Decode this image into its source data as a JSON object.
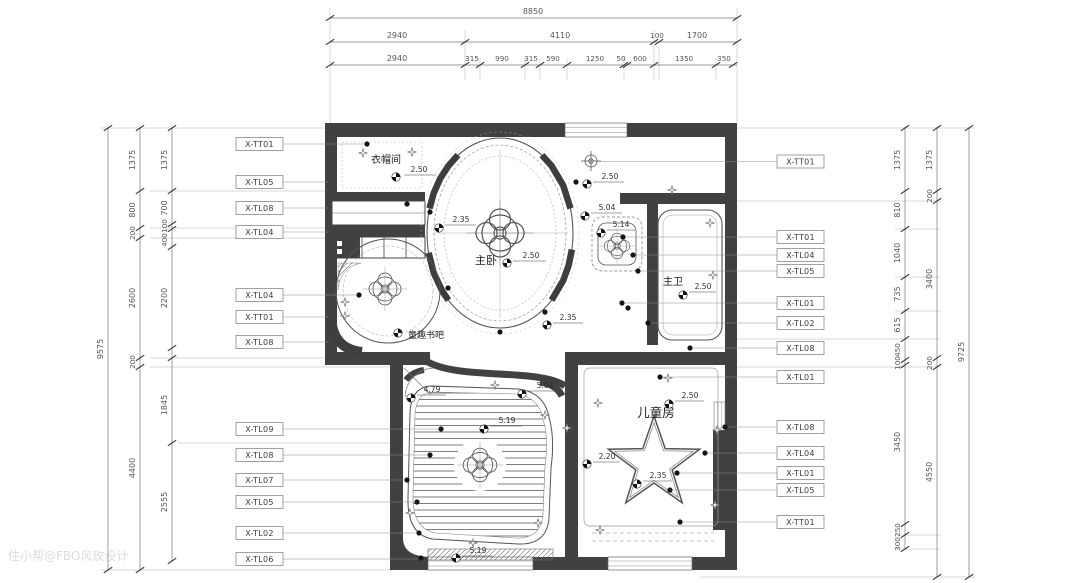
{
  "watermark": "住小帮@FBO风玫设计",
  "dims": {
    "top": {
      "total": "8850",
      "row2": [
        "2940",
        "4110",
        "100",
        "1700"
      ],
      "row3": [
        "2940",
        "315",
        "990",
        "315",
        "590",
        "1250",
        "50",
        "600",
        "1350",
        "350"
      ]
    },
    "left": {
      "total": "9575",
      "mid": [
        "1375",
        "800",
        "200",
        "2600",
        "200",
        "4400"
      ],
      "inner": [
        "1375",
        "700",
        "100",
        "400",
        "2200",
        "1845",
        "2555"
      ]
    },
    "right": {
      "total": "9725",
      "mid": [
        "1375",
        "200",
        "3400",
        "200",
        "4550"
      ],
      "inner": [
        "1375",
        "810",
        "1040",
        "735",
        "615",
        "450",
        "100",
        "3450",
        "250",
        "300"
      ]
    }
  },
  "callouts": {
    "left": [
      "X-TT01",
      "X-TL05",
      "X-TL08",
      "X-TL04",
      "X-TL04",
      "X-TT01",
      "X-TL08",
      "X-TL09",
      "X-TL08",
      "X-TL07",
      "X-TL05",
      "X-TL02",
      "X-TL06"
    ],
    "right": [
      "X-TT01",
      "X-TT01",
      "X-TL04",
      "X-TL05",
      "X-TL01",
      "X-TL02",
      "X-TL08",
      "X-TL01",
      "X-TL08",
      "X-TL04",
      "X-TL01",
      "X-TL05",
      "X-TT01"
    ]
  },
  "rooms": {
    "cloakroom": "衣帽间",
    "master": "主卧",
    "bath": "主卫",
    "kids": "儿童房",
    "bar": "童趣书吧"
  },
  "elevations": {
    "cloakroom": "2.50",
    "master_ne": "2.50",
    "oval_w": "2.35",
    "master": "2.50",
    "master_s": "2.35",
    "niche_a": "5.04",
    "niche_b": "5.14",
    "bath": "2.50",
    "south_nw": "4.79",
    "south_ne": "5.04",
    "south_c": "5.19",
    "south_s": "5.19",
    "kids_n": "2.50",
    "kids_w": "2.20",
    "kids_c": "2.35"
  }
}
